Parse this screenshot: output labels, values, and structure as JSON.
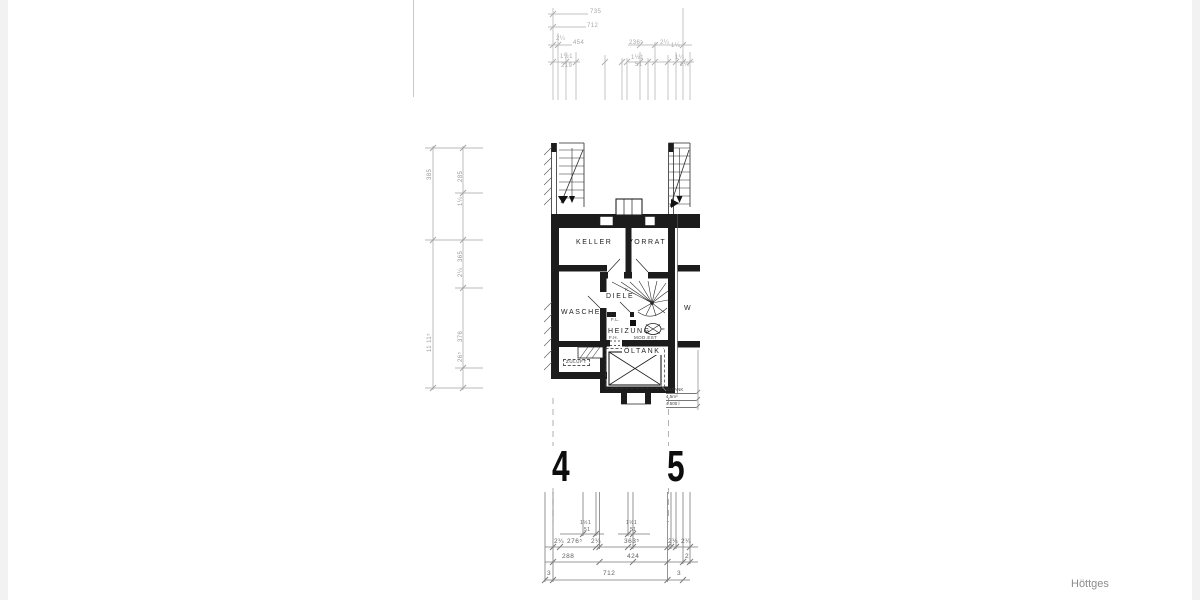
{
  "watermark": "Höttges",
  "axes": {
    "left": "4",
    "right": "5"
  },
  "rooms": {
    "keller": "KELLER",
    "vorrat": "VORRAT",
    "waschen": "WASCHEN",
    "diele": "DIELE",
    "heizung": "HEIZUNG",
    "oeltank": "ÖLTANK",
    "neighbor": "W"
  },
  "annotations": {
    "zuluft": "ZULUFT",
    "stair_k": "K",
    "fl": "F.L.",
    "fh": "F.H.",
    "modest": "MOD.EST",
    "tank_note_1": "ÖLTANK",
    "tank_note_2": "4,5m³",
    "tank_note_3": "4.500 l"
  },
  "dims": {
    "top": [
      "735",
      "712",
      "454",
      "2¼",
      "1½1",
      "219",
      "236⁵",
      "2¼",
      "1¼",
      "1½1",
      "51",
      "1¼",
      "2¼"
    ],
    "left": [
      "385",
      "285",
      "1¼",
      "365",
      "2¼",
      "376",
      "26⁵",
      "11 11⁵"
    ],
    "bottom_a": [
      "1½1",
      "51",
      "1½1",
      "51"
    ],
    "bottom_b": [
      "2¼",
      "276⁵",
      "2¼",
      "363⁵",
      "2¼",
      "2¼"
    ],
    "bottom_c": [
      "288",
      "424",
      "2"
    ],
    "bottom_d": [
      "3",
      "712",
      "3"
    ]
  }
}
